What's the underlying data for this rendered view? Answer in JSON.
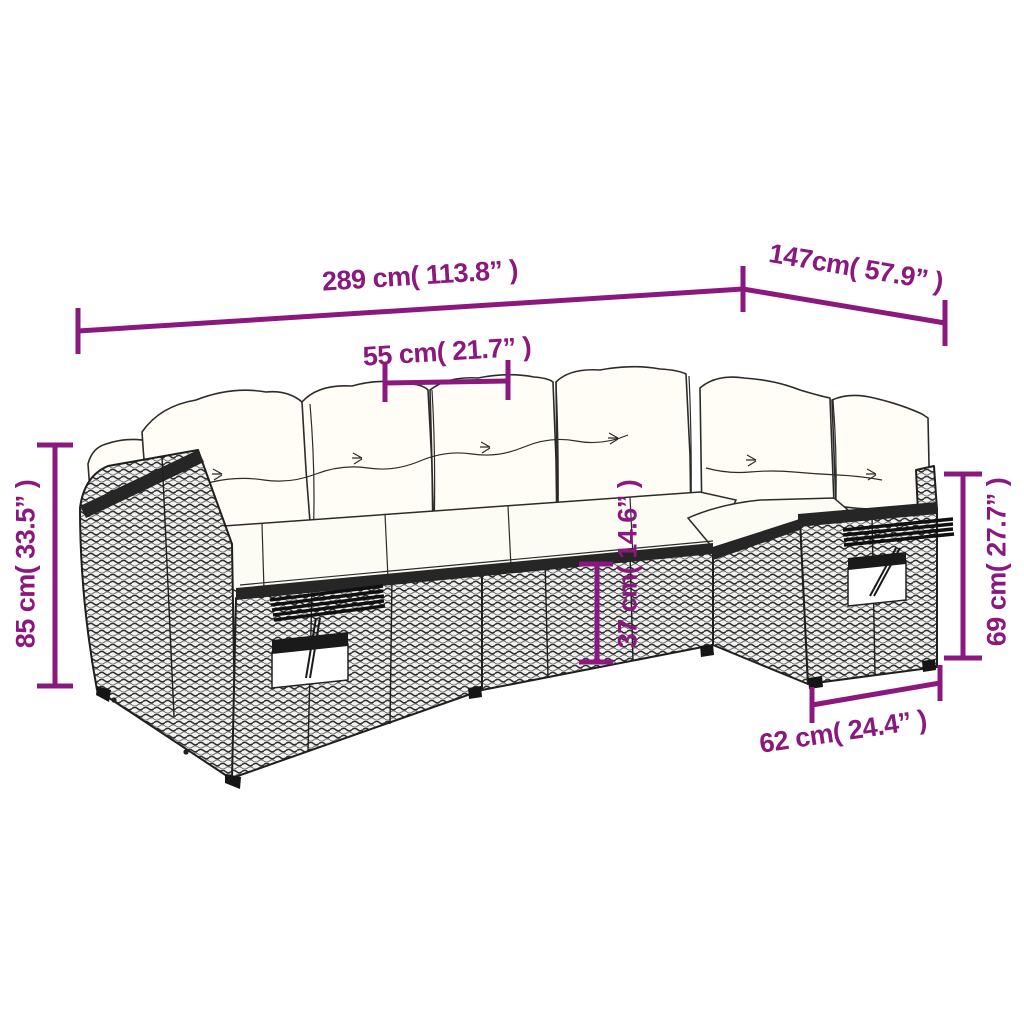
{
  "canvas": {
    "width": 1024,
    "height": 1024,
    "background": "#ffffff"
  },
  "style": {
    "accent_color": "#8b187f",
    "outline_color": "#1f1f1f",
    "cushion_color": "#fffdf6",
    "rattan_tone": "#9a9a9a"
  },
  "illustration": "rattan corner sofa set line drawing with white cushions and fold-down shelves",
  "dimensions": {
    "total_width": {
      "cm": "289",
      "inches": "113.8",
      "label": "289 cm( 113.8” )"
    },
    "right_depth": {
      "cm": "147",
      "inches": "57.9",
      "label": "147cm( 57.9” )"
    },
    "seat_width": {
      "cm": "55",
      "inches": "21.7",
      "label": "55 cm( 21.7” )"
    },
    "back_height": {
      "cm": "85",
      "inches": "33.5",
      "label": "85 cm( 33.5” )"
    },
    "arm_back_height": {
      "cm": "69",
      "inches": "27.7",
      "label": "69 cm( 27.7” )"
    },
    "seat_height": {
      "cm": "37",
      "inches": "14.6",
      "label": "37 cm( 14.6” )"
    },
    "section_depth": {
      "cm": "62",
      "inches": "24.4",
      "label": "62 cm( 24.4” )"
    }
  }
}
